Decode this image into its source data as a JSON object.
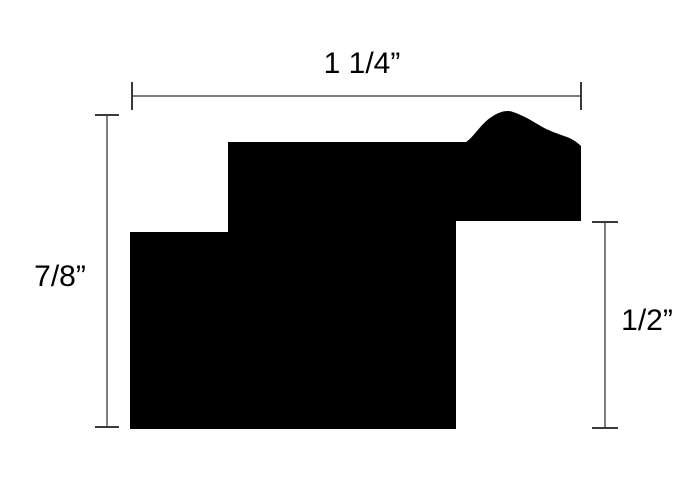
{
  "diagram": {
    "background_color": "#ffffff",
    "profile_color": "#000000",
    "dimension_line_color": "#7f7f7f",
    "dimension_tick_color": "#3a3a3a"
  },
  "dimensions": {
    "top_label": "1 1/4”",
    "left_label": "7/8”",
    "right_label": "1/2”"
  }
}
